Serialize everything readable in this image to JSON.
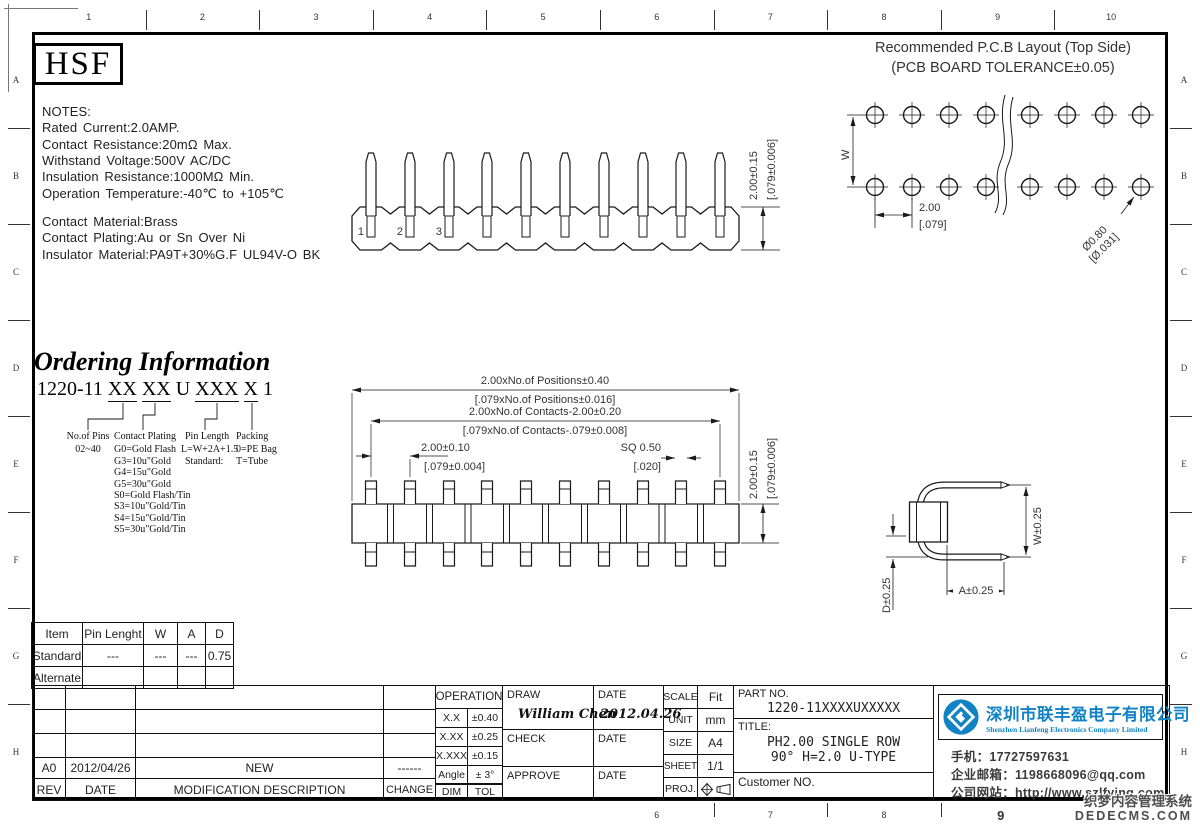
{
  "ruler": {
    "top": [
      "1",
      "2",
      "3",
      "4",
      "5",
      "6",
      "7",
      "8",
      "9",
      "10"
    ],
    "bottom": [
      "6",
      "7",
      "8",
      "9"
    ],
    "left": [
      "A",
      "B",
      "C",
      "D",
      "E",
      "F",
      "G",
      "H"
    ],
    "right": [
      "A",
      "B",
      "C",
      "D",
      "E",
      "F",
      "G",
      "H"
    ]
  },
  "logo_text": "HSF",
  "notes": {
    "lines": [
      "NOTES:",
      "Rated Current:2.0AMP.",
      "Contact Resistance:20mΩ Max.",
      "Withstand Voltage:500V AC/DC",
      "Insulation Resistance:1000MΩ Min.",
      "Operation Temperature:-40℃ to +105℃",
      "Contact Material:Brass",
      "Contact Plating:Au or Sn Over Ni",
      "Insulator Material:PA9T+30%G.F UL94V-O BK"
    ]
  },
  "pcb": {
    "title1": "Recommended P.C.B Layout (Top Side)",
    "title2": "(PCB BOARD TOLERANCE±0.05)",
    "dim_w": "W",
    "dim_pitch_mm": "2.00",
    "dim_pitch_in": "[.079]",
    "dim_hole_mm": "Ø0.80",
    "dim_hole_in": "[Ø.031]"
  },
  "top_view": {
    "pins": [
      "1",
      "2",
      "3"
    ],
    "dim_h_mm": "2.00±0.15",
    "dim_h_in": "[.079±0.006]"
  },
  "front_view": {
    "dim_positions_mm": "2.00xNo.of Positions±0.40",
    "dim_positions_in": "[.079xNo.of Positions±0.016]",
    "dim_contacts_mm": "2.00xNo.of Contacts-2.00±0.20",
    "dim_contacts_in": "[.079xNo.of Contacts-.079±0.008]",
    "dim_pitch_mm": "2.00±0.10",
    "dim_pitch_in": "[.079±0.004]",
    "dim_sq_mm": "SQ 0.50",
    "dim_sq_in": "[.020]",
    "dim_h_mm": "2.00±0.15",
    "dim_h_in": "[.079±0.006]"
  },
  "side_view": {
    "dim_w": "W±0.25",
    "dim_a": "A±0.25",
    "dim_d": "D±0.25"
  },
  "ordering": {
    "title": "Ordering Information",
    "code_parts": [
      {
        "t": "1220-11 "
      },
      {
        "t": "XX"
      },
      {
        "t": " "
      },
      {
        "t": "XX"
      },
      {
        "t": " U "
      },
      {
        "t": "XXX"
      },
      {
        "t": " "
      },
      {
        "t": "X"
      },
      {
        "t": " 1"
      }
    ],
    "col1_header": "No.of Pins",
    "col1_items": [
      "02~40"
    ],
    "col2_header": "Contact Plating",
    "col2_items": [
      "G0=Gold Flash",
      "G3=10u\"Gold",
      "G4=15u\"Gold",
      "G5=30u\"Gold",
      "S0=Gold Flash/Tin",
      "S3=10u\"Gold/Tin",
      "S4=15u\"Gold/Tin",
      "S5=30u\"Gold/Tin"
    ],
    "col3_header": "Pin Length",
    "col3_items": [
      "L=W+2A+1.5",
      "Standard:"
    ],
    "col4_header": "Packing",
    "col4_items": [
      "0=PE Bag",
      "T=Tube"
    ]
  },
  "spec": {
    "headers": [
      "Item",
      "Pin Lenght",
      "W",
      "A",
      "D"
    ],
    "standard": {
      "label": "Standard",
      "pin_length": "---",
      "w": "---",
      "a": "---",
      "d": "0.75"
    },
    "alternate": {
      "label": "Alternate",
      "pin_length": "",
      "w": "",
      "a": "",
      "d": ""
    }
  },
  "tol": {
    "header": "OPERATION",
    "rows": [
      [
        "X.X",
        "±0.40"
      ],
      [
        "X.XX",
        "±0.25"
      ],
      [
        "X.XXX",
        "±0.15"
      ],
      [
        "Angle",
        "± 3°"
      ],
      [
        "DIM",
        "TOL"
      ]
    ]
  },
  "sign": {
    "draw": "DRAW",
    "date": "DATE",
    "check": "CHECK",
    "approve": "APPROVE",
    "drawn_by": "William Chen",
    "draw_date": "2012.04.26"
  },
  "meta": {
    "scale_label": "SCALE",
    "scale": "Fit",
    "unit_label": "UNIT",
    "unit": "mm",
    "size_label": "SIZE",
    "size": "A4",
    "sheet_label": "SHEET",
    "sheet": "1/1",
    "proj_label": "PROJ."
  },
  "part": {
    "part_label": "PART NO.",
    "part_no": "1220-11XXXXUXXXXX",
    "title_label": "TITLE:",
    "title_line1": "PH2.00 SINGLE ROW",
    "title_line2": "90° H=2.0 U-TYPE",
    "customer_label": "Customer NO."
  },
  "rev": {
    "rev": "A0",
    "date": "2012/04/26",
    "description": "NEW",
    "change": "------",
    "headers": [
      "REV",
      "DATE",
      "MODIFICATION DESCRIPTION",
      "CHANGE"
    ]
  },
  "company": {
    "brand_color": "#1183c4",
    "name_cn": "深圳市联丰盈电子有限公司",
    "name_en": "Shenzhen Lianfeng Electronics Company Limited",
    "phone": "手机：17727597631",
    "email": "企业邮箱：1198668096@qq.com",
    "website": "公司网站：http://www.szlfying.com"
  },
  "watermark": {
    "line1": "织梦内容管理系统",
    "line2": "DEDECMS.COM"
  }
}
